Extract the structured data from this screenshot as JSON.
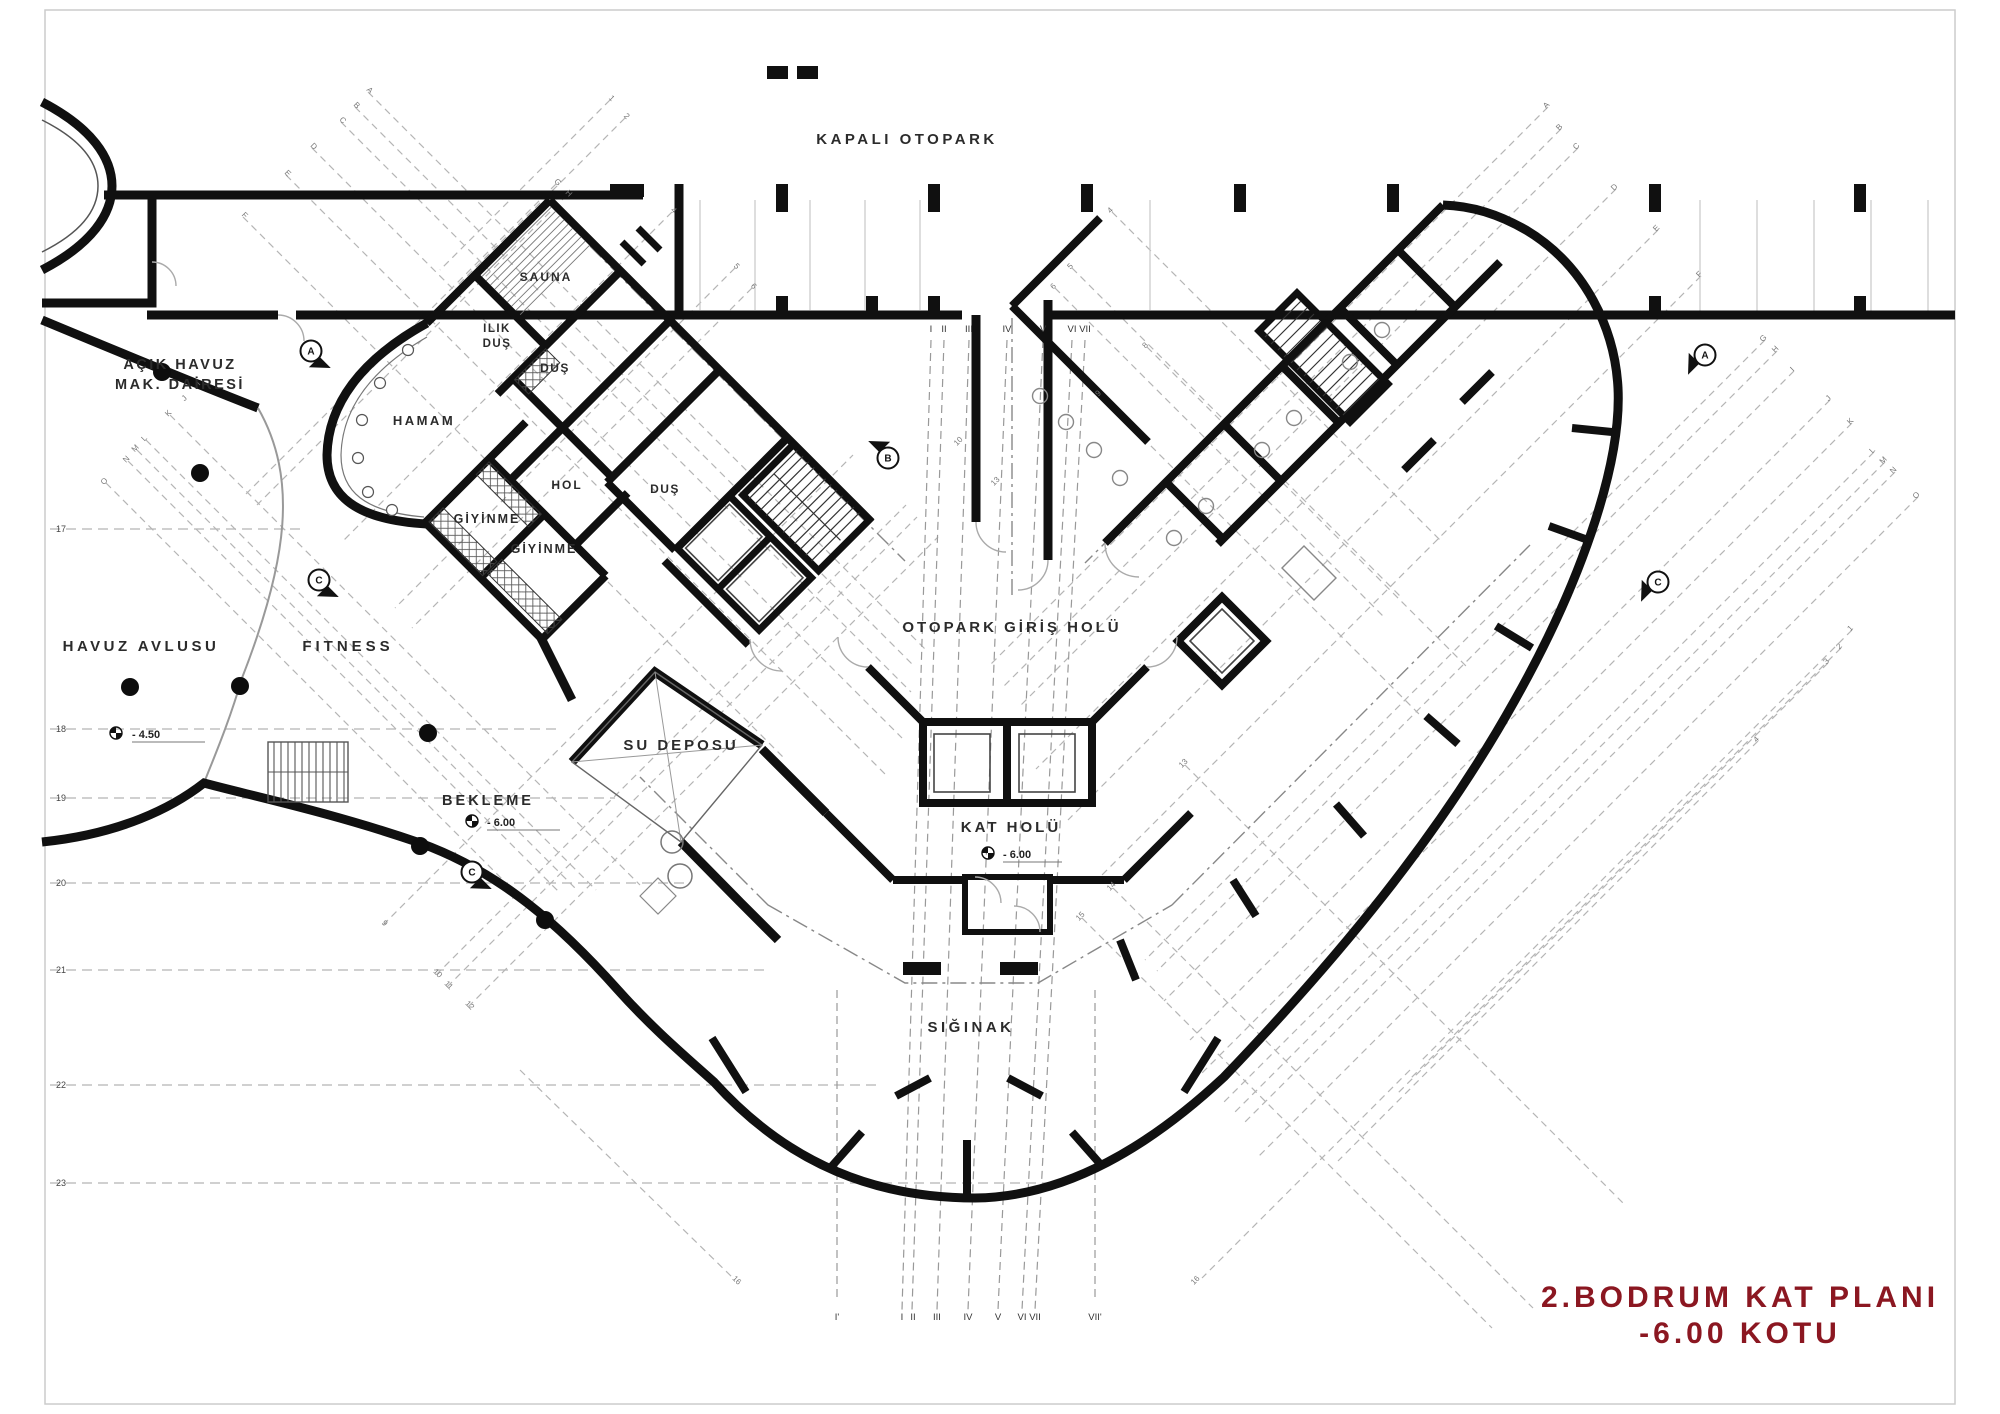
{
  "title": {
    "line1": "2.BODRUM KAT PLANI",
    "line2": "-6.00 KOTU",
    "color": "#8b1721"
  },
  "rooms": [
    {
      "id": "kapali-otopark",
      "label": "KAPALI OTOPARK",
      "x": 907,
      "y": 144,
      "fs": 15,
      "ls": 3.5
    },
    {
      "id": "acik-havuz-line1",
      "label": "AÇIK HAVUZ",
      "x": 180,
      "y": 369,
      "fs": 14.5,
      "ls": 2.5
    },
    {
      "id": "acik-havuz-line2",
      "label": "MAK. DAİRESİ",
      "x": 180,
      "y": 389,
      "fs": 14.5,
      "ls": 2.5
    },
    {
      "id": "sauna",
      "label": "SAUNA",
      "x": 546,
      "y": 281,
      "fs": 12,
      "ls": 2
    },
    {
      "id": "ilik-dus-line1",
      "label": "ILIK",
      "x": 497,
      "y": 332,
      "fs": 11.5,
      "ls": 1.5
    },
    {
      "id": "ilik-dus-line2",
      "label": "DUŞ",
      "x": 497,
      "y": 347,
      "fs": 11.5,
      "ls": 1.5
    },
    {
      "id": "dus-1",
      "label": "DUŞ",
      "x": 555,
      "y": 372,
      "fs": 12,
      "ls": 1.5
    },
    {
      "id": "hamam",
      "label": "HAMAM",
      "x": 424,
      "y": 425,
      "fs": 13,
      "ls": 2.5
    },
    {
      "id": "hol",
      "label": "HOL",
      "x": 567,
      "y": 489,
      "fs": 12,
      "ls": 2
    },
    {
      "id": "dus-2",
      "label": "DUŞ",
      "x": 665,
      "y": 493,
      "fs": 12,
      "ls": 1.5
    },
    {
      "id": "giyinme-1",
      "label": "GİYİNME",
      "x": 487,
      "y": 523,
      "fs": 12.5,
      "ls": 2
    },
    {
      "id": "giyinme-2",
      "label": "GİYİNME",
      "x": 544,
      "y": 553,
      "fs": 12.5,
      "ls": 2
    },
    {
      "id": "havuz-avlusu",
      "label": "HAVUZ AVLUSU",
      "x": 141,
      "y": 651,
      "fs": 15,
      "ls": 3.5
    },
    {
      "id": "fitness",
      "label": "FITNESS",
      "x": 348,
      "y": 651,
      "fs": 15,
      "ls": 4
    },
    {
      "id": "su-deposu",
      "label": "SU DEPOSU",
      "x": 681,
      "y": 750,
      "fs": 15,
      "ls": 3
    },
    {
      "id": "bekleme",
      "label": "BEKLEME",
      "x": 488,
      "y": 805,
      "fs": 14.5,
      "ls": 3
    },
    {
      "id": "otopark-giris-holu",
      "label": "OTOPARK GİRİŞ HOLÜ",
      "x": 1012,
      "y": 632,
      "fs": 15,
      "ls": 3
    },
    {
      "id": "kat-holu",
      "label": "KAT HOLÜ",
      "x": 1011,
      "y": 832,
      "fs": 15,
      "ls": 3
    },
    {
      "id": "siginak",
      "label": "SIĞINAK",
      "x": 971,
      "y": 1032,
      "fs": 15,
      "ls": 3.5
    }
  ],
  "elevations": [
    {
      "text": "- 4.50",
      "x": 132,
      "y": 738,
      "sx": 116,
      "sy": 733,
      "lineTo": 205
    },
    {
      "text": "- 6.00",
      "x": 487,
      "y": 826,
      "sx": 472,
      "sy": 821,
      "lineTo": 560
    },
    {
      "text": "- 6.00",
      "x": 1003,
      "y": 858,
      "sx": 988,
      "sy": 853,
      "lineTo": 1062
    }
  ],
  "grid": {
    "left_rows": [
      {
        "n": "17",
        "y": 529
      },
      {
        "n": "18",
        "y": 729
      },
      {
        "n": "19",
        "y": 798
      },
      {
        "n": "20",
        "y": 883
      },
      {
        "n": "21",
        "y": 970
      },
      {
        "n": "22",
        "y": 1085
      },
      {
        "n": "23",
        "y": 1183
      }
    ],
    "top_roman_y": 332,
    "top_romans": [
      {
        "n": "I",
        "x": 931
      },
      {
        "n": "II",
        "x": 944
      },
      {
        "n": "III",
        "x": 969
      },
      {
        "n": "IV",
        "x": 1007
      },
      {
        "n": "V",
        "x": 1043
      },
      {
        "n": "VI",
        "x": 1072
      },
      {
        "n": "VII",
        "x": 1085
      }
    ],
    "bottom_roman_y": 1320,
    "bottom_romans": [
      {
        "n": "I'",
        "x": 837
      },
      {
        "n": "I",
        "x": 902
      },
      {
        "n": "II",
        "x": 913
      },
      {
        "n": "III",
        "x": 937
      },
      {
        "n": "IV",
        "x": 968
      },
      {
        "n": "V",
        "x": 998
      },
      {
        "n": "VI",
        "x": 1022
      },
      {
        "n": "VII",
        "x": 1035
      },
      {
        "n": "VII'",
        "x": 1095
      }
    ],
    "letters": [
      {
        "t": "A",
        "x": 368,
        "y": 92,
        "r": 45
      },
      {
        "t": "B",
        "x": 355,
        "y": 107,
        "r": 45
      },
      {
        "t": "C",
        "x": 341,
        "y": 122,
        "r": 45
      },
      {
        "t": "D",
        "x": 312,
        "y": 148,
        "r": 45
      },
      {
        "t": "E",
        "x": 286,
        "y": 175,
        "r": 45
      },
      {
        "t": "F",
        "x": 243,
        "y": 217,
        "r": 45
      },
      {
        "t": "G",
        "x": 556,
        "y": 184,
        "r": 45
      },
      {
        "t": "H",
        "x": 567,
        "y": 195,
        "r": 45
      },
      {
        "t": "I",
        "x": 200,
        "y": 385,
        "r": -45
      },
      {
        "t": "J",
        "x": 186,
        "y": 400,
        "r": -45
      },
      {
        "t": "K",
        "x": 170,
        "y": 415,
        "r": -45
      },
      {
        "t": "L",
        "x": 146,
        "y": 440,
        "r": -45
      },
      {
        "t": "M",
        "x": 137,
        "y": 450,
        "r": -45
      },
      {
        "t": "N",
        "x": 128,
        "y": 461,
        "r": -45
      },
      {
        "t": "O",
        "x": 106,
        "y": 483,
        "r": -45
      },
      {
        "t": "A",
        "x": 1548,
        "y": 107,
        "r": -45
      },
      {
        "t": "B",
        "x": 1561,
        "y": 129,
        "r": -45
      },
      {
        "t": "C",
        "x": 1578,
        "y": 148,
        "r": -45
      },
      {
        "t": "D",
        "x": 1616,
        "y": 189,
        "r": -45
      },
      {
        "t": "E",
        "x": 1658,
        "y": 230,
        "r": -45
      },
      {
        "t": "F",
        "x": 1701,
        "y": 276,
        "r": -45
      },
      {
        "t": "G",
        "x": 1765,
        "y": 340,
        "r": -45
      },
      {
        "t": "H",
        "x": 1777,
        "y": 351,
        "r": -45
      },
      {
        "t": "I",
        "x": 1794,
        "y": 371,
        "r": -45
      },
      {
        "t": "J",
        "x": 1830,
        "y": 400,
        "r": -45
      },
      {
        "t": "K",
        "x": 1852,
        "y": 423,
        "r": -45
      },
      {
        "t": "L",
        "x": 1874,
        "y": 452,
        "r": -45
      },
      {
        "t": "M",
        "x": 1885,
        "y": 462,
        "r": -45
      },
      {
        "t": "N",
        "x": 1895,
        "y": 472,
        "r": -45
      },
      {
        "t": "O",
        "x": 1918,
        "y": 497,
        "r": -45
      }
    ],
    "numbers": [
      {
        "t": "1",
        "x": 610,
        "y": 100,
        "r": 45
      },
      {
        "t": "2",
        "x": 625,
        "y": 118,
        "r": 45
      },
      {
        "t": "4",
        "x": 672,
        "y": 212,
        "r": 45
      },
      {
        "t": "5",
        "x": 735,
        "y": 268,
        "r": 45
      },
      {
        "t": "6",
        "x": 752,
        "y": 288,
        "r": 45
      },
      {
        "t": "4",
        "x": 1112,
        "y": 212,
        "r": -45
      },
      {
        "t": "5",
        "x": 1072,
        "y": 268,
        "r": -45
      },
      {
        "t": "6",
        "x": 1055,
        "y": 288,
        "r": -45
      },
      {
        "t": "8",
        "x": 1147,
        "y": 347,
        "r": -45
      },
      {
        "t": "9",
        "x": 1100,
        "y": 395,
        "r": -45
      },
      {
        "t": "10",
        "x": 960,
        "y": 443,
        "r": -45
      },
      {
        "t": "13",
        "x": 997,
        "y": 483,
        "r": -45
      },
      {
        "t": "9",
        "x": 383,
        "y": 925,
        "r": 45
      },
      {
        "t": "10",
        "x": 436,
        "y": 975,
        "r": 45
      },
      {
        "t": "11",
        "x": 447,
        "y": 987,
        "r": 45
      },
      {
        "t": "12",
        "x": 468,
        "y": 1007,
        "r": 45
      },
      {
        "t": "13",
        "x": 1185,
        "y": 765,
        "r": -45
      },
      {
        "t": "14",
        "x": 1113,
        "y": 888,
        "r": -45
      },
      {
        "t": "15",
        "x": 1082,
        "y": 918,
        "r": -45
      },
      {
        "t": "16",
        "x": 735,
        "y": 1282,
        "r": 45
      },
      {
        "t": "16",
        "x": 1197,
        "y": 1282,
        "r": -45
      },
      {
        "t": "1",
        "x": 1852,
        "y": 630,
        "r": -45
      },
      {
        "t": "2",
        "x": 1841,
        "y": 648,
        "r": -45
      },
      {
        "t": "3",
        "x": 1828,
        "y": 663,
        "r": -45
      },
      {
        "t": "4",
        "x": 1758,
        "y": 741,
        "r": -45
      }
    ]
  },
  "section_markers": [
    {
      "t": "A",
      "x": 311,
      "y": 351,
      "rot": 135
    },
    {
      "t": "A",
      "x": 1705,
      "y": 355,
      "rot": 225
    },
    {
      "t": "B",
      "x": 888,
      "y": 458,
      "rot": 315
    },
    {
      "t": "C",
      "x": 319,
      "y": 580,
      "rot": 135
    },
    {
      "t": "C",
      "x": 472,
      "y": 872,
      "rot": 135
    },
    {
      "t": "C",
      "x": 1658,
      "y": 582,
      "rot": 225
    }
  ],
  "colors": {
    "wall": "#101010",
    "grid": "#b5b5b5",
    "title": "#8b1721"
  }
}
